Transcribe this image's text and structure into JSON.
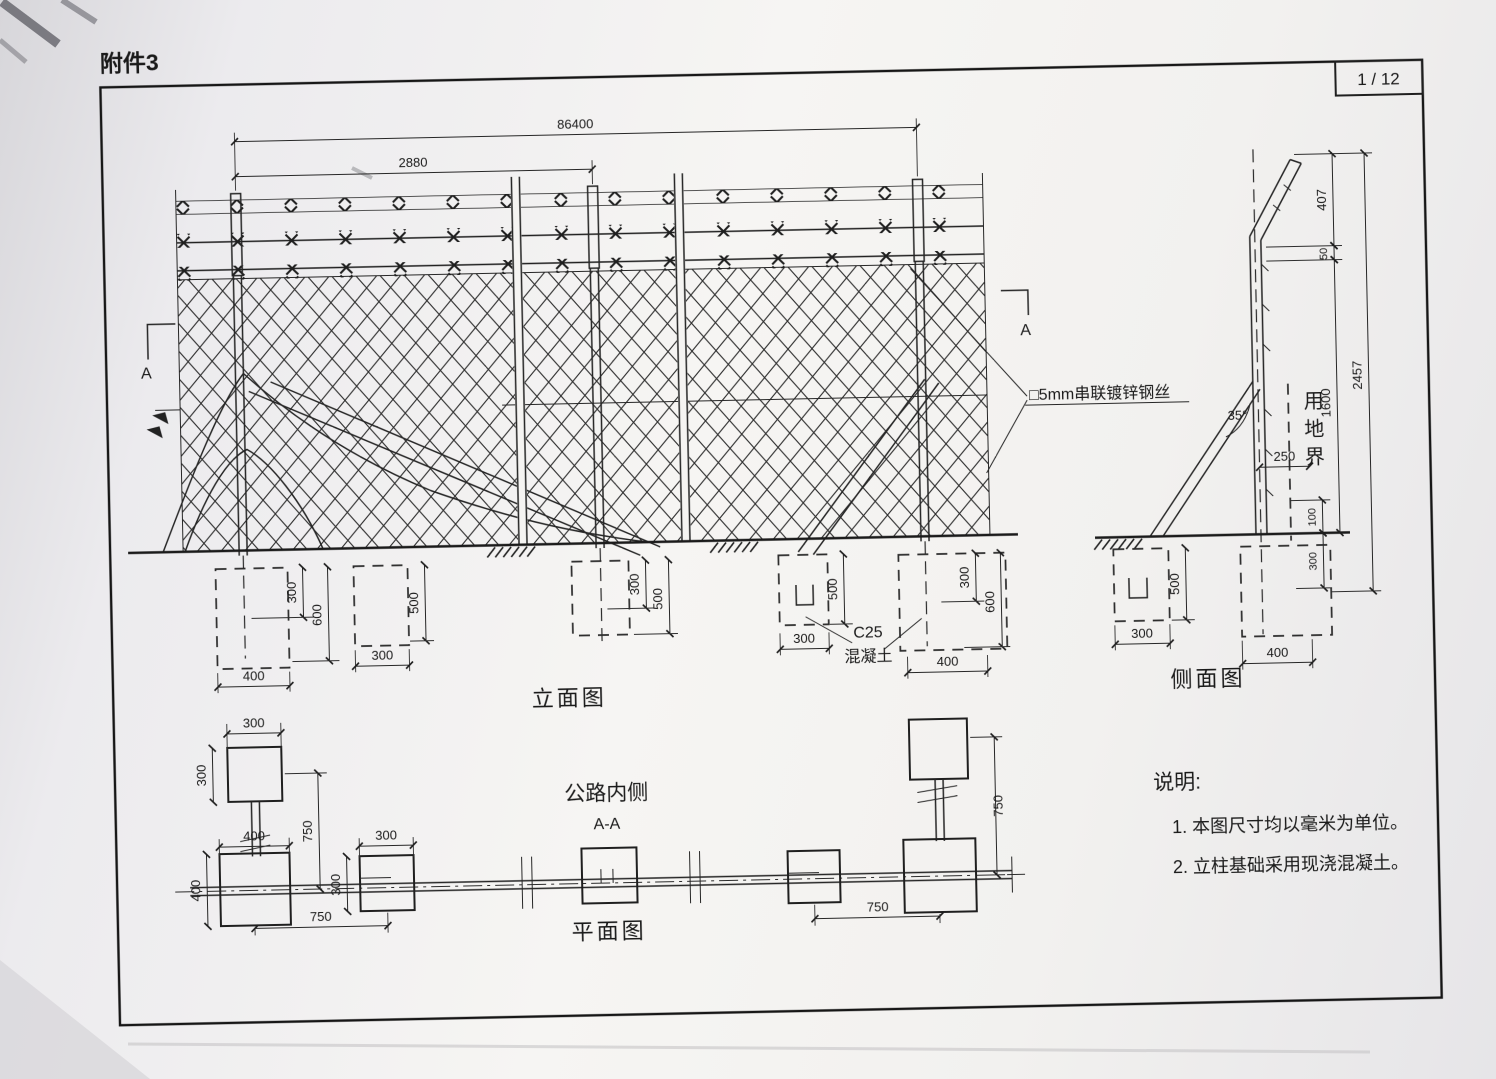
{
  "page": {
    "attachment_label": "附件3",
    "page_number": "1 / 12"
  },
  "views": {
    "elevation": {
      "title": "立面图",
      "dim_total_length": "86400",
      "dim_post_spacing": "2880",
      "section_mark_left": "A",
      "section_mark_right": "A",
      "wire_label": "□5mm串联镀锌钢丝",
      "concrete_grade": "C25",
      "concrete_material": "混凝土",
      "foundation_left": {
        "embed_depth": "300",
        "depth": "600",
        "width": "400"
      },
      "foundation_left_small": {
        "depth": "500",
        "width": "300"
      },
      "foundation_mid": {
        "embed_depth": "300",
        "depth": "500"
      },
      "foundation_right_small": {
        "depth": "500",
        "width": "300"
      },
      "foundation_right": {
        "embed_depth": "300",
        "depth": "600",
        "width": "400"
      }
    },
    "side": {
      "title": "侧面图",
      "dim_arm": "407",
      "dim_wire_gap": "50",
      "dim_post_height": "1600",
      "dim_total_height": "2457",
      "dim_offset": "250",
      "dim_boundary_above": "100",
      "dim_embed": "300",
      "brace_angle": "35°",
      "boundary_label": "用地界",
      "foundation_left": {
        "width": "300",
        "depth": "500"
      },
      "foundation_right": {
        "width": "400"
      }
    },
    "plan": {
      "title": "平面图",
      "road_side_label": "公路内侧",
      "section_label": "A-A",
      "dim_top_width": "300",
      "dim_top_height": "300",
      "dim_left_spacing": "750",
      "dim_base_width": "400",
      "dim_base_height": "400",
      "dim_small_width": "300",
      "dim_small_height": "300",
      "dim_bottom_span": "750",
      "dim_right_spacing": "750",
      "dim_right_span": "750"
    },
    "notes": {
      "title": "说明:",
      "item1": "1. 本图尺寸均以毫米为单位。",
      "item2": "2. 立柱基础采用现浇混凝土。"
    }
  }
}
